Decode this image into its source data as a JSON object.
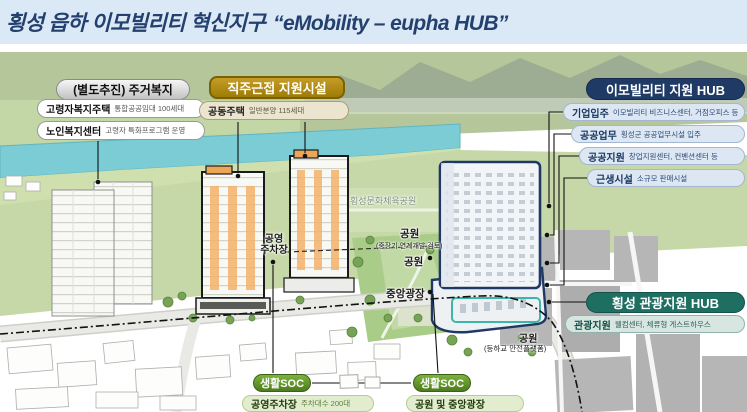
{
  "title": {
    "ko": "횡성 읍하 이모빌리티 혁신지구",
    "en": "“eMobility – eupha HUB”"
  },
  "callouts": {
    "housing": {
      "header": "(별도추진) 주거복지",
      "items": [
        {
          "label": "고령자복지주택",
          "desc": "통합공공임대 100세대"
        },
        {
          "label": "노인복지센터",
          "desc": "고령자 특화프로그램 운영"
        }
      ]
    },
    "worklive": {
      "header": "직주근접 지원시설",
      "items": [
        {
          "label": "공동주택",
          "desc": "일반분양 115세대"
        }
      ]
    },
    "emobility": {
      "header": "이모빌리티 지원 HUB",
      "items": [
        {
          "label": "기업입주",
          "desc": "이모빌리티 비즈니스센터, 거점오피스 등"
        },
        {
          "label": "공공업무",
          "desc": "횡성군 공공업무시설 입주"
        },
        {
          "label": "공공지원",
          "desc": "창업지원센터, 컨벤션센터 등"
        },
        {
          "label": "근생시설",
          "desc": "소규모 판매시설"
        }
      ]
    },
    "tourism": {
      "header": "횡성 관광지원 HUB",
      "items": [
        {
          "label": "관광지원",
          "desc": "웰컴센터, 체류형 게스트하우스"
        }
      ]
    },
    "soc_parking": {
      "header": "생활SOC",
      "label": "공영주차장",
      "desc": "주차대수 200대"
    },
    "soc_park": {
      "header": "생활SOC",
      "label": "공원 및 중앙광장"
    }
  },
  "map_labels": {
    "sports_park": "횡성문화체육공원",
    "public_parking_line1": "공영",
    "public_parking_line2": "주차장",
    "park_midterm": "공원",
    "park_midterm_sub": "(중장기 연계개발 검토)",
    "park_center": "공원",
    "central_plaza": "중앙광장",
    "park_safety": "공원",
    "park_safety_sub": "(등하교 안전플랫폼)"
  },
  "colors": {
    "title_navy": "#24406e",
    "hub_navy": "#203a66",
    "hub_teal": "#1e6e62",
    "soc_green": "#5a8f29",
    "header_gold": "#a98410",
    "band_blue": "#dbe9f6",
    "river_teal": "#7bccd4",
    "building_accent_orange": "#f3b269"
  }
}
